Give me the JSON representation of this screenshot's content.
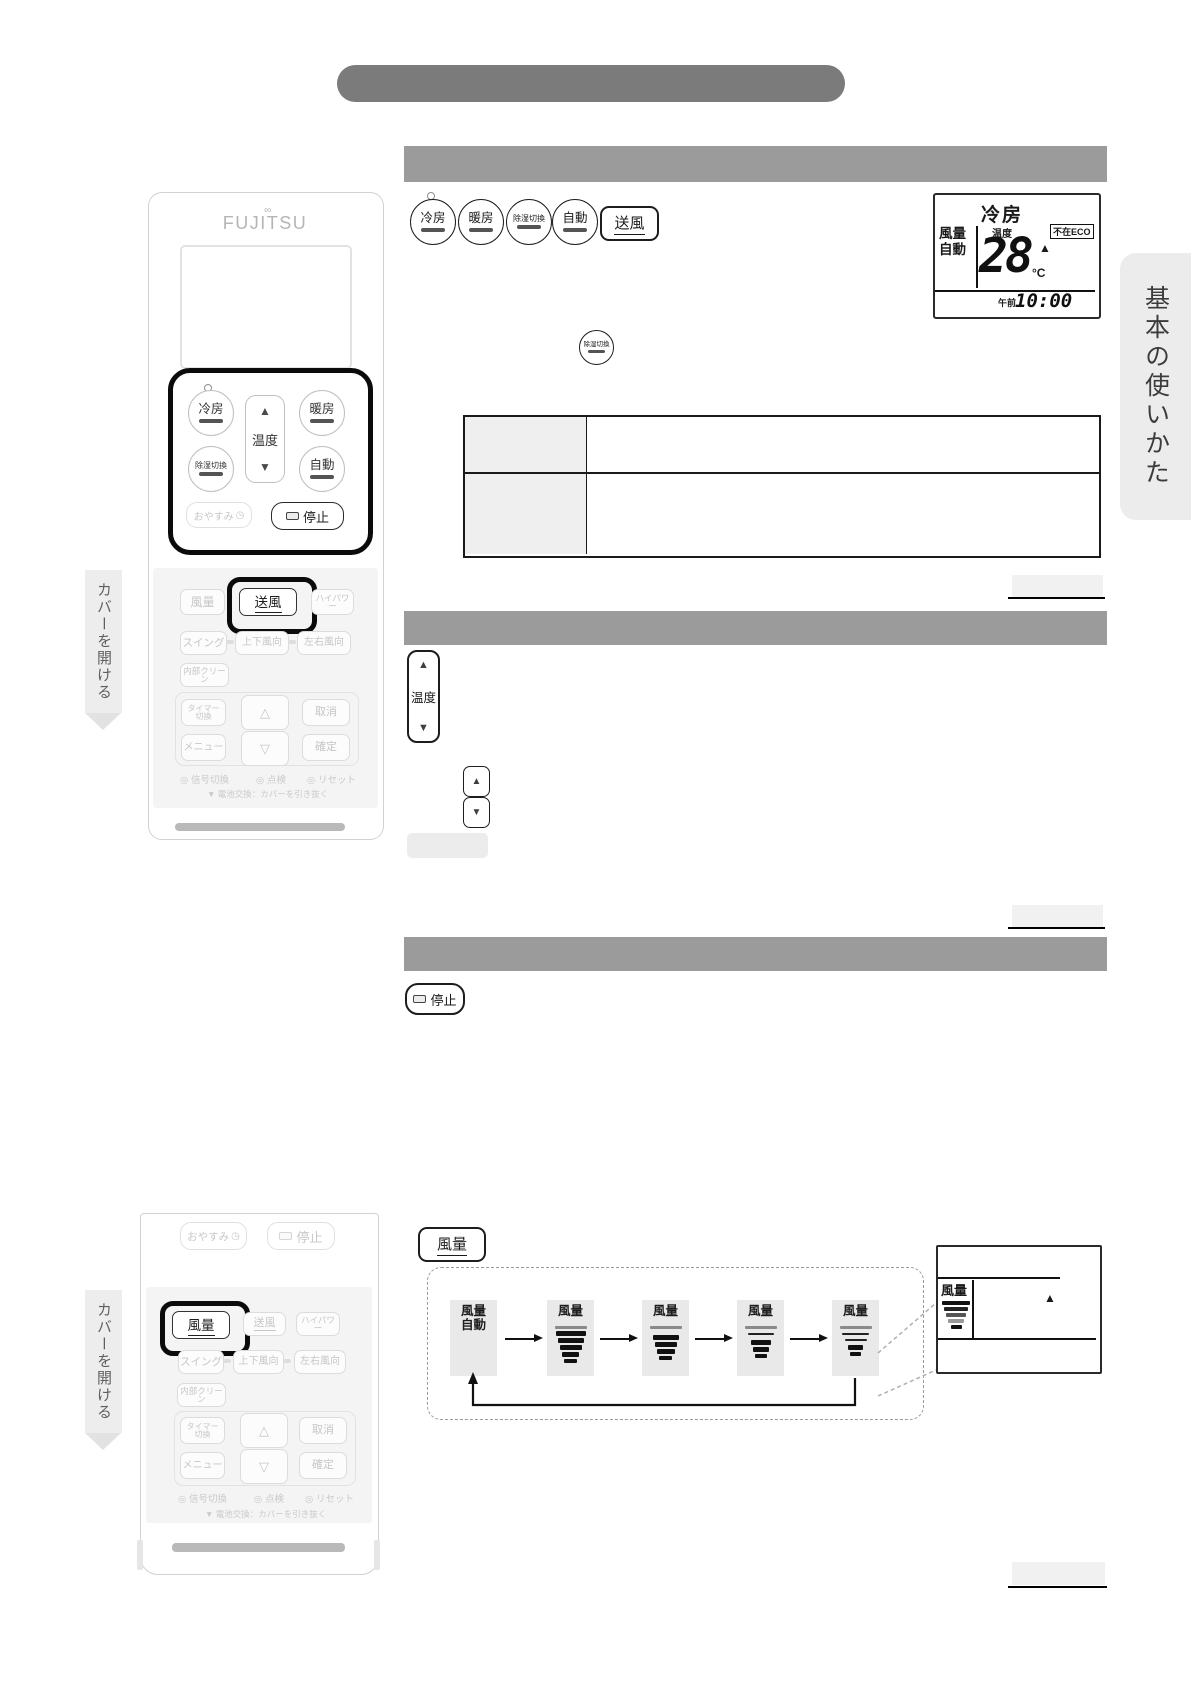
{
  "labels": {
    "brand": "FUJITSU",
    "cool": "冷房",
    "heat": "暖房",
    "dehumidify": "除湿切換",
    "auto": "自動",
    "vent": "送風",
    "fan": "風量",
    "temp": "温度",
    "sleep": "おやすみ",
    "stop": "停止",
    "hipower": "ハイパワー",
    "swing": "スイング",
    "updown": "上下風向",
    "leftright": "左右風向",
    "clean": "内部クリーン",
    "timer_l1": "タイマー",
    "timer_l2": "切換",
    "cancel": "取消",
    "menu": "メニュー",
    "confirm": "確定",
    "signal": "信号切換",
    "check": "点検",
    "reset": "リセット",
    "battery_note": "電池交換：カバーを引き抜く",
    "open_cover": "カバーを開ける",
    "tab": "基本の使いかた",
    "fan_auto_l1": "風量",
    "fan_auto_l2": "自動"
  },
  "lcd_main": {
    "mode": "冷房",
    "fan_l1": "風量",
    "fan_l2": "自動",
    "temp_label": "温度",
    "temp_value": "28",
    "eco": "不在ECO",
    "unit": "°C",
    "ampm": "午前",
    "time": "10:00"
  },
  "lcd_fan": {
    "fan_label": "風量"
  },
  "icons": {
    "up": "▲",
    "down": "▼",
    "up_outline": "△",
    "down_outline": "▽",
    "bullet": "◎",
    "battery_marker": "▼",
    "clock": "◷",
    "logo_accent": "∞"
  },
  "colors": {
    "title_bar": "#7b7b7b",
    "section_bar": "#9b9b9b",
    "tab_bg": "#ececec",
    "panel_bg": "#f4f4f4",
    "disabled_text": "#c6c6c6",
    "ink": "#1a1a1a"
  }
}
